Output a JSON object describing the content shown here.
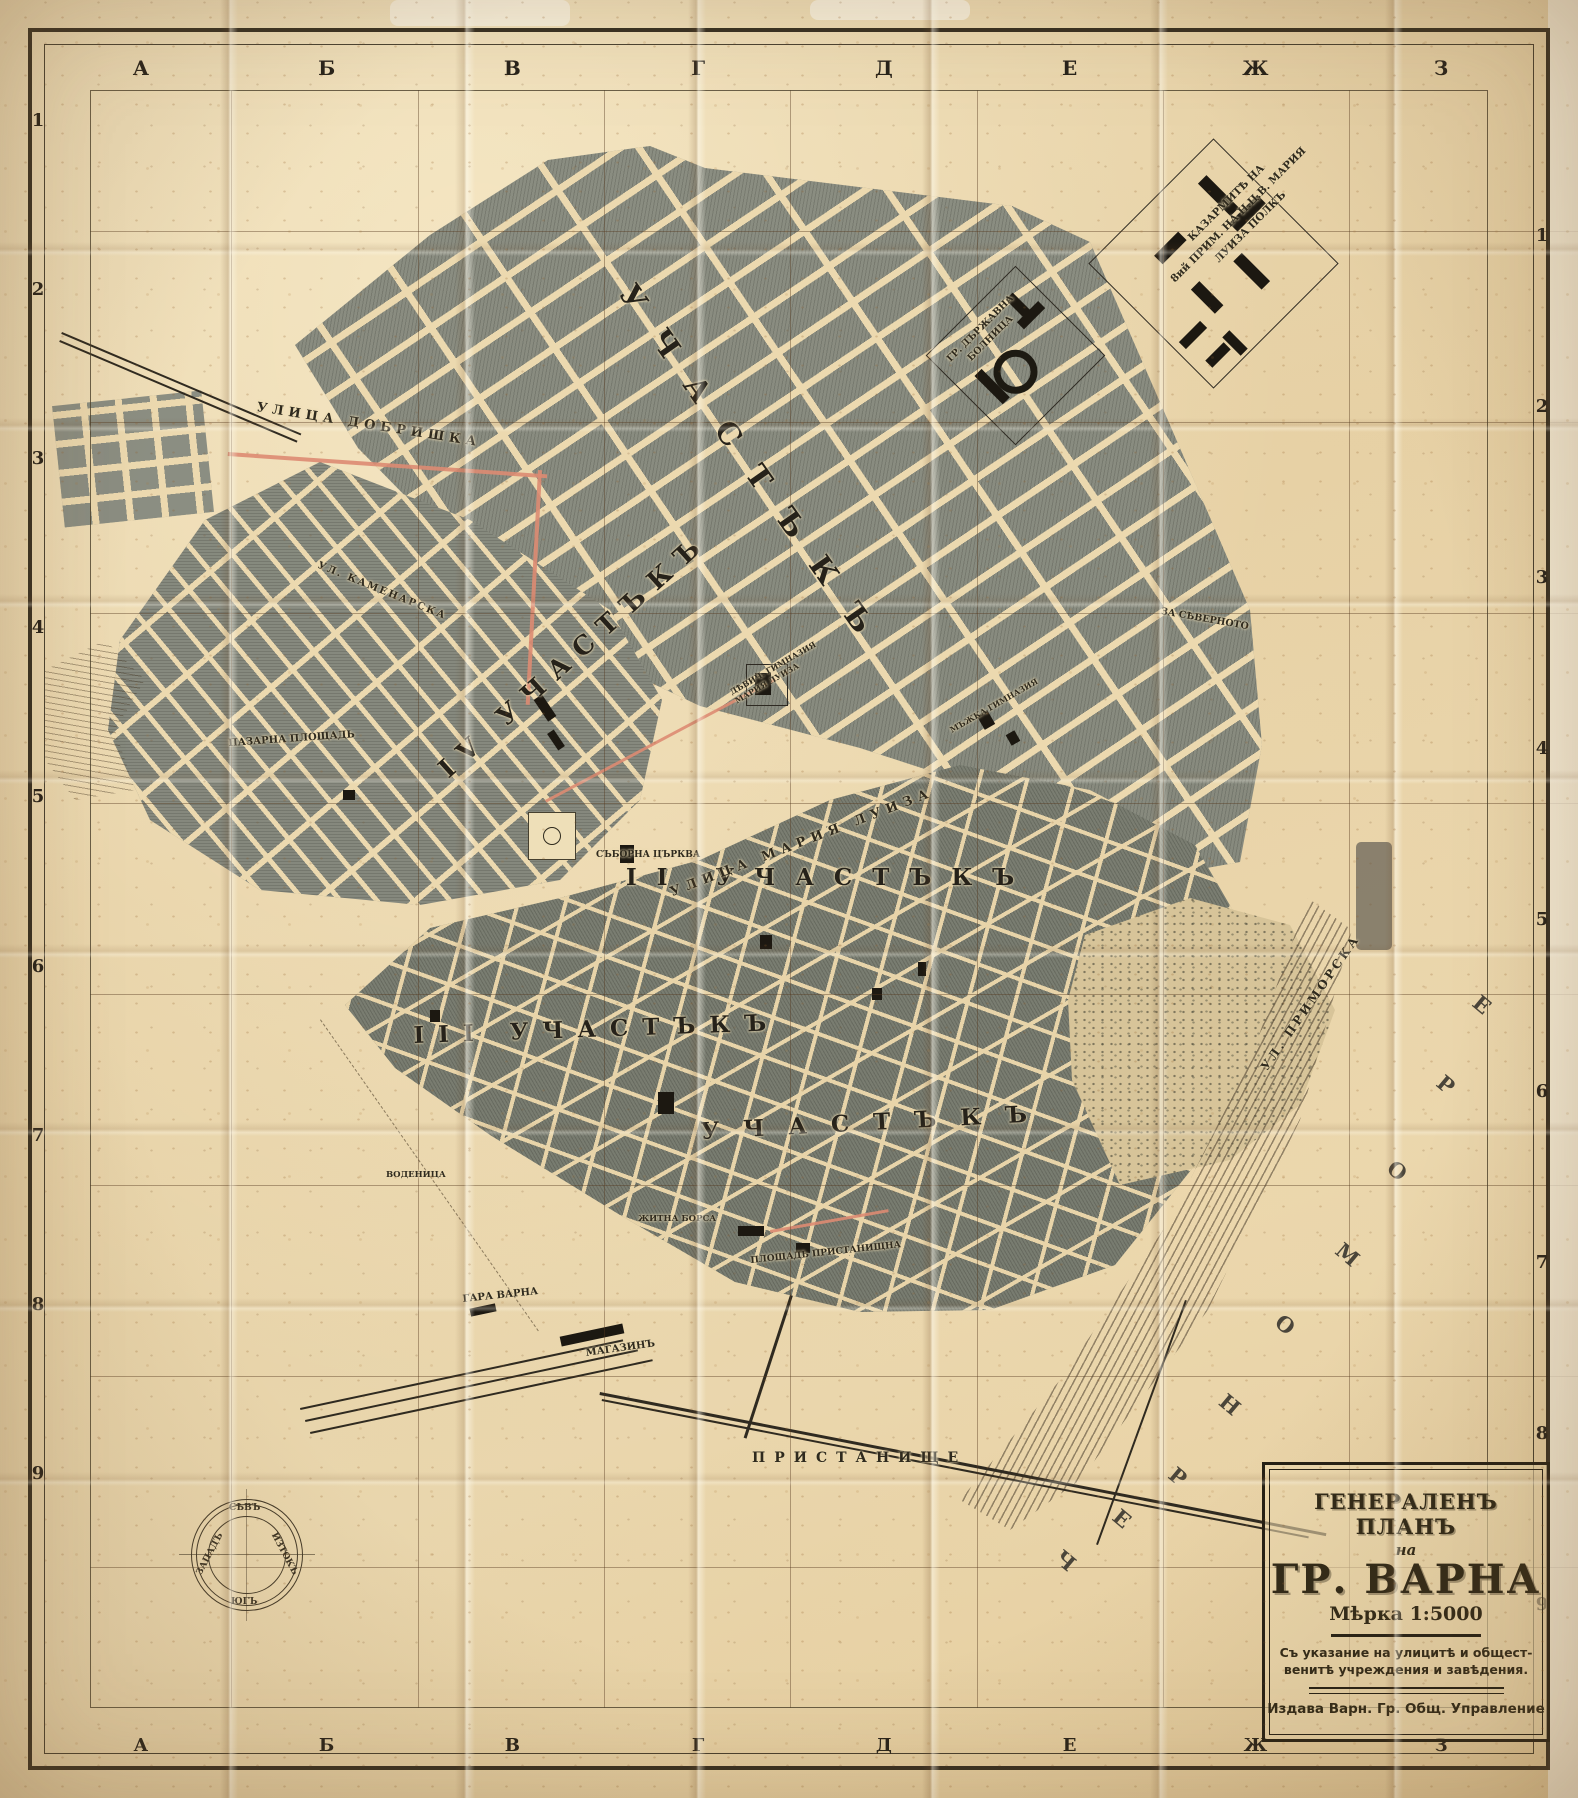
{
  "map_title": "Генераленъ планъ на гр. Варна",
  "grid": {
    "top_letters": [
      "А",
      "Б",
      "В",
      "Г",
      "Д",
      "Е",
      "Ж",
      "З"
    ],
    "bottom_letters": [
      "А",
      "Б",
      "В",
      "Г",
      "Д",
      "Е",
      "Ж",
      "З"
    ],
    "left_numbers": [
      "1",
      "2",
      "3",
      "4",
      "5",
      "6",
      "7",
      "8",
      "9"
    ],
    "right_numbers": [
      "1",
      "2",
      "3",
      "4",
      "5",
      "6",
      "7",
      "8",
      "9"
    ]
  },
  "cartouche": {
    "title_line1": "ГЕНЕРАЛЕНЪ ПЛАНЪ",
    "title_line2": "на",
    "title_line3": "ГР. ВАРНА",
    "scale": "Мѣрка 1:5000",
    "subtitle": "Съ указание на улицитѣ и общест-\nвенитѣ учреждения и завѣдения.",
    "publisher": "Издава Варн. Гр. Общ. Управление"
  },
  "compass": {
    "north": "СѢВЪ",
    "south": "ЮГЪ",
    "west": "ЗАПАДЪ",
    "east": "ИЗТОКЪ"
  },
  "sea": {
    "name": "ЧЕРНО МОРЕ",
    "letters": [
      "Ч",
      "Е",
      "Р",
      "Н",
      "О",
      "М",
      "О",
      "Р",
      "Е"
    ]
  },
  "labels": [
    {
      "text": "УЧАСТЪКЪ"
    },
    {
      "text": "II УЧАСТЪКЪ"
    },
    {
      "text": "III УЧАСТЪКЪ"
    },
    {
      "text": "УЧАСТЪКЪ"
    },
    {
      "text": "IV УЧАСТЪКЪ"
    },
    {
      "text": "УЛИЦА ДОБРИШКА"
    },
    {
      "text": "УЛ. КАМЕНАРСКА"
    },
    {
      "text": "ПАЗАРНА ПЛОЩАДЬ"
    },
    {
      "text": "СЪБОРНА ЦЪРКВА"
    },
    {
      "text": "УЛИЦА МАРИЯ ЛУИЗА"
    },
    {
      "text": "УЛ. ПРИМОРСКА"
    },
    {
      "text": "ПЛОЩАДЬ ПРИСТАНИЩНА"
    },
    {
      "text": "ПРИСТАНИЩЕ"
    },
    {
      "text": "ГАРА ВАРНА"
    },
    {
      "text": "МАГАЗИНЪ"
    },
    {
      "text": "ЖИТНА БОРСА"
    },
    {
      "text": "ВОДЕНИЦА"
    },
    {
      "text": "КАЗАРМИТѢ НА\n8ий ПРИМ. НА Н.Ц.В. МАРИЯ\nЛУИЗА ПОЛКЪ"
    },
    {
      "text": "ГР. ДЪРЖАВНА\nБОЛНИЦА"
    },
    {
      "text": "ЗА СѢВЕРНОТО"
    },
    {
      "text": "ДѢВИЧ. ГИМНАЗИЯ\nМАРИЯ ЛУИЗА"
    },
    {
      "text": "МЪЖКА ГИМНАЗИЯ"
    }
  ]
}
